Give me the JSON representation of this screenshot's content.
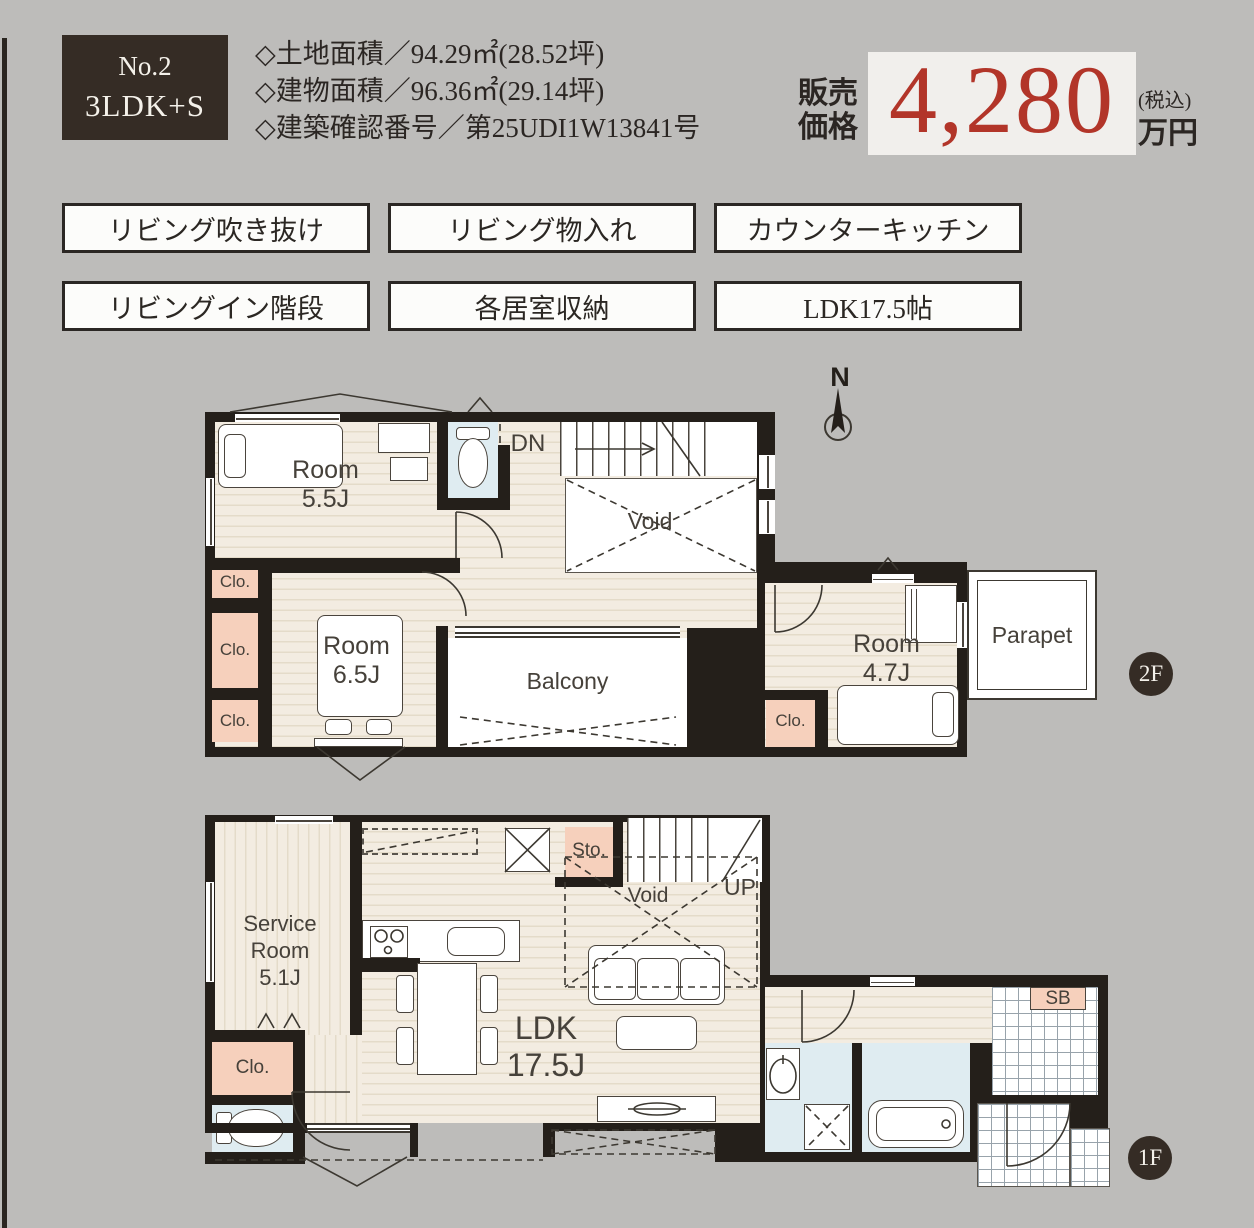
{
  "header": {
    "unit_no": "No.2",
    "unit_type": "3LDK+S",
    "specs": [
      "◇土地面積／94.29㎡(28.52坪)",
      "◇建物面積／96.36㎡(29.14坪)",
      "◇建築確認番号／第25UDI1W13841号"
    ],
    "price": {
      "label_top": "販売",
      "label_bottom": "価格",
      "amount": "4,280",
      "tax_note": "(税込)",
      "unit": "万円"
    }
  },
  "features": [
    "リビング吹き抜け",
    "リビング物入れ",
    "カウンターキッチン",
    "リビングイン階段",
    "各居室収納",
    "LDK17.5帖"
  ],
  "plan_2f": {
    "badge": "2F",
    "compass_n": "N",
    "room_a": {
      "name": "Room",
      "size": "5.5J"
    },
    "room_b": {
      "name": "Room",
      "size": "6.5J"
    },
    "room_c": {
      "name": "Room",
      "size": "4.7J"
    },
    "stairs": "DN",
    "void": "Void",
    "balcony": "Balcony",
    "parapet": "Parapet",
    "closet": "Clo."
  },
  "plan_1f": {
    "badge": "1F",
    "service_room": {
      "line1": "Service",
      "line2": "Room",
      "line3": "5.1J"
    },
    "ldk": {
      "name": "LDK",
      "size": "17.5J"
    },
    "storage": "Sto.",
    "void": "Void",
    "stairs": "UP",
    "shoe_box": "SB",
    "closet": "Clo."
  },
  "colors": {
    "accent_red": "#b23529",
    "badge_brown": "#352c25",
    "floor_beige": "#f3ece1",
    "closet_peach": "#f6d0bc",
    "wet_blue": "#dfecf1",
    "wall": "#241f1a",
    "background": "#bdbcba"
  }
}
